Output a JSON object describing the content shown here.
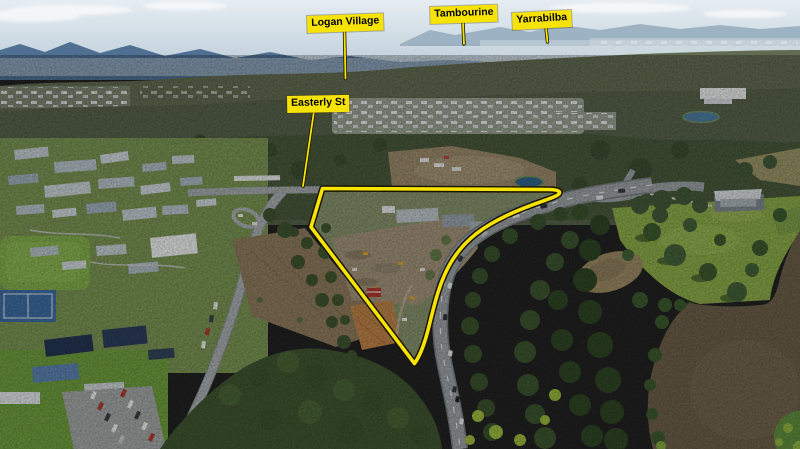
{
  "photo": {
    "kind": "aerial-property-photograph",
    "colors": {
      "sky": "#cfdce5",
      "mountains": "#4f7093",
      "forest": "#49593c",
      "field": "#8cab49",
      "river": "#6c5f49",
      "road": "#9ba1a5"
    }
  },
  "annotations": {
    "boundary_color": "#f7e300",
    "boundary_outline_color": "#181400",
    "labels": [
      {
        "id": "logan-village",
        "text": "Logan Village"
      },
      {
        "id": "tambourine",
        "text": "Tambourine"
      },
      {
        "id": "yarrabilba",
        "text": "Yarrabilba"
      },
      {
        "id": "easterly-st",
        "text": "Easterly St"
      }
    ]
  }
}
